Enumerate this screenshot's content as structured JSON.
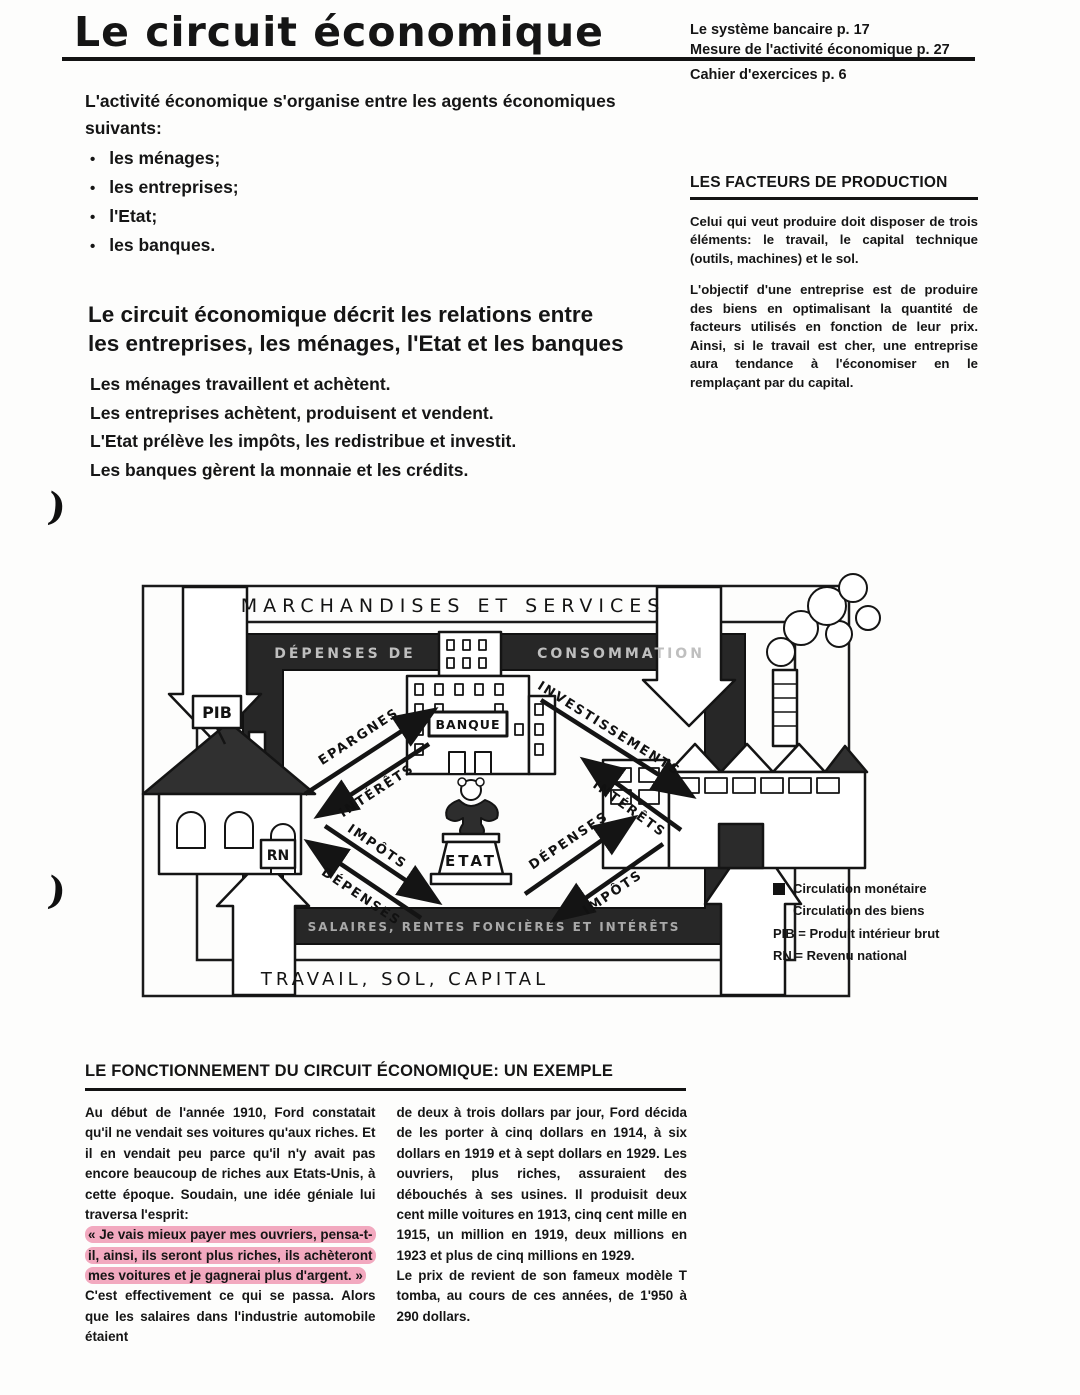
{
  "header": {
    "title": "Le circuit économique",
    "ref1": "Le système bancaire p. 17",
    "ref2": "Mesure de l'activité économique p. 27",
    "ref3": "Cahier d'exercices p. 6"
  },
  "intro": {
    "lead": "L'activité économique s'organise entre les agents économiques suivants:",
    "bullet_glyph": "•",
    "bullets": [
      "les ménages;",
      "les entreprises;",
      "l'Etat;",
      "les banques."
    ]
  },
  "sidebar": {
    "heading": "LES FACTEURS DE PRODUCTION",
    "para1": "Celui qui veut produire doit disposer de trois éléments: le travail, le capital technique (outils, machines) et le sol.",
    "para2": "L'objectif d'une entreprise est de produire des biens en optimalisant la quantité de facteurs utilisés en fonction de leur prix. Ainsi, si le travail est cher, une entreprise aura tendance à l'économiser en le remplaçant par du capital."
  },
  "section": {
    "heading_line1": "Le circuit économique décrit les relations entre",
    "heading_line2": "les entreprises, les ménages, l'Etat et les banques",
    "statements": [
      "Les ménages travaillent et achètent.",
      "Les entreprises achètent, produisent et vendent.",
      "L'Etat prélève les impôts, les redistribue et investit.",
      "Les banques gèrent la monnaie et les crédits."
    ]
  },
  "margin_marks": {
    "mark1": ")",
    "mark2": ")"
  },
  "diagram": {
    "outer_top": "MARCHANDISES ET SERVICES",
    "outer_bottom": "TRAVAIL, SOL, CAPITAL",
    "inner_top_left": "DÉPENSES DE",
    "inner_top_right": "CONSOMMATION",
    "inner_bottom": "SALAIRES, RENTES FONCIÈRES ET INTÉRÊTS",
    "bank_sign": "BANQUE",
    "etat_sign": "ETAT",
    "pib_sign": "PIB",
    "rn_sign": "RN",
    "arrows": {
      "epargnes": "EPARGNES",
      "interets_left": "INTÉRÊTS",
      "investissements": "INVESTISSEMENTS",
      "interets_right": "INTÉRÊTS",
      "impots_left": "IMPÔTS",
      "depenses_left": "DÉPENSES",
      "depenses_right": "DÉPENSES",
      "impots_right": "IMPÔTS"
    }
  },
  "legend": {
    "item1": "Circulation monétaire",
    "item2": "Circulation des biens",
    "abbr1": "PIB = Produit intérieur brut",
    "abbr2": "RN = Revenu national"
  },
  "example": {
    "heading": "LE FONCTIONNEMENT DU CIRCUIT ÉCONOMIQUE: UN EXEMPLE",
    "col1_pre": "Au début de l'année 1910, Ford constatait qu'il ne vendait ses voitures qu'aux riches. Et il en vendait peu parce qu'il n'y avait pas encore beaucoup de riches aux Etats-Unis, à cette époque. Soudain, une idée géniale lui traversa l'esprit:",
    "col1_highlight": "« Je vais mieux payer mes ouvriers, pensa-t-il, ainsi, ils seront plus riches, ils achèteront mes voitures et je gagnerai plus d'argent. »",
    "col1_post": "C'est effectivement ce qui se passa. Alors que les salaires dans l'industrie automobile étaient",
    "col2_para1": "de deux à trois dollars par jour, Ford décida de les porter à cinq dollars en 1914, à six dollars en 1919 et à sept dollars en 1929. Les ouvriers, plus riches, assuraient des débouchés à ses usines. Il produisit deux cent mille voitures en 1913, cinq cent mille en 1915, un million en 1919, deux millions en 1923 et plus de cinq millions en 1929.",
    "col2_para2": "Le prix de revient de son fameux modèle T tomba, au cours de ces années, de 1'950 à 290 dollars."
  },
  "colors": {
    "highlight": "#f2a9bf",
    "ink": "#151515",
    "band": "#272727"
  }
}
